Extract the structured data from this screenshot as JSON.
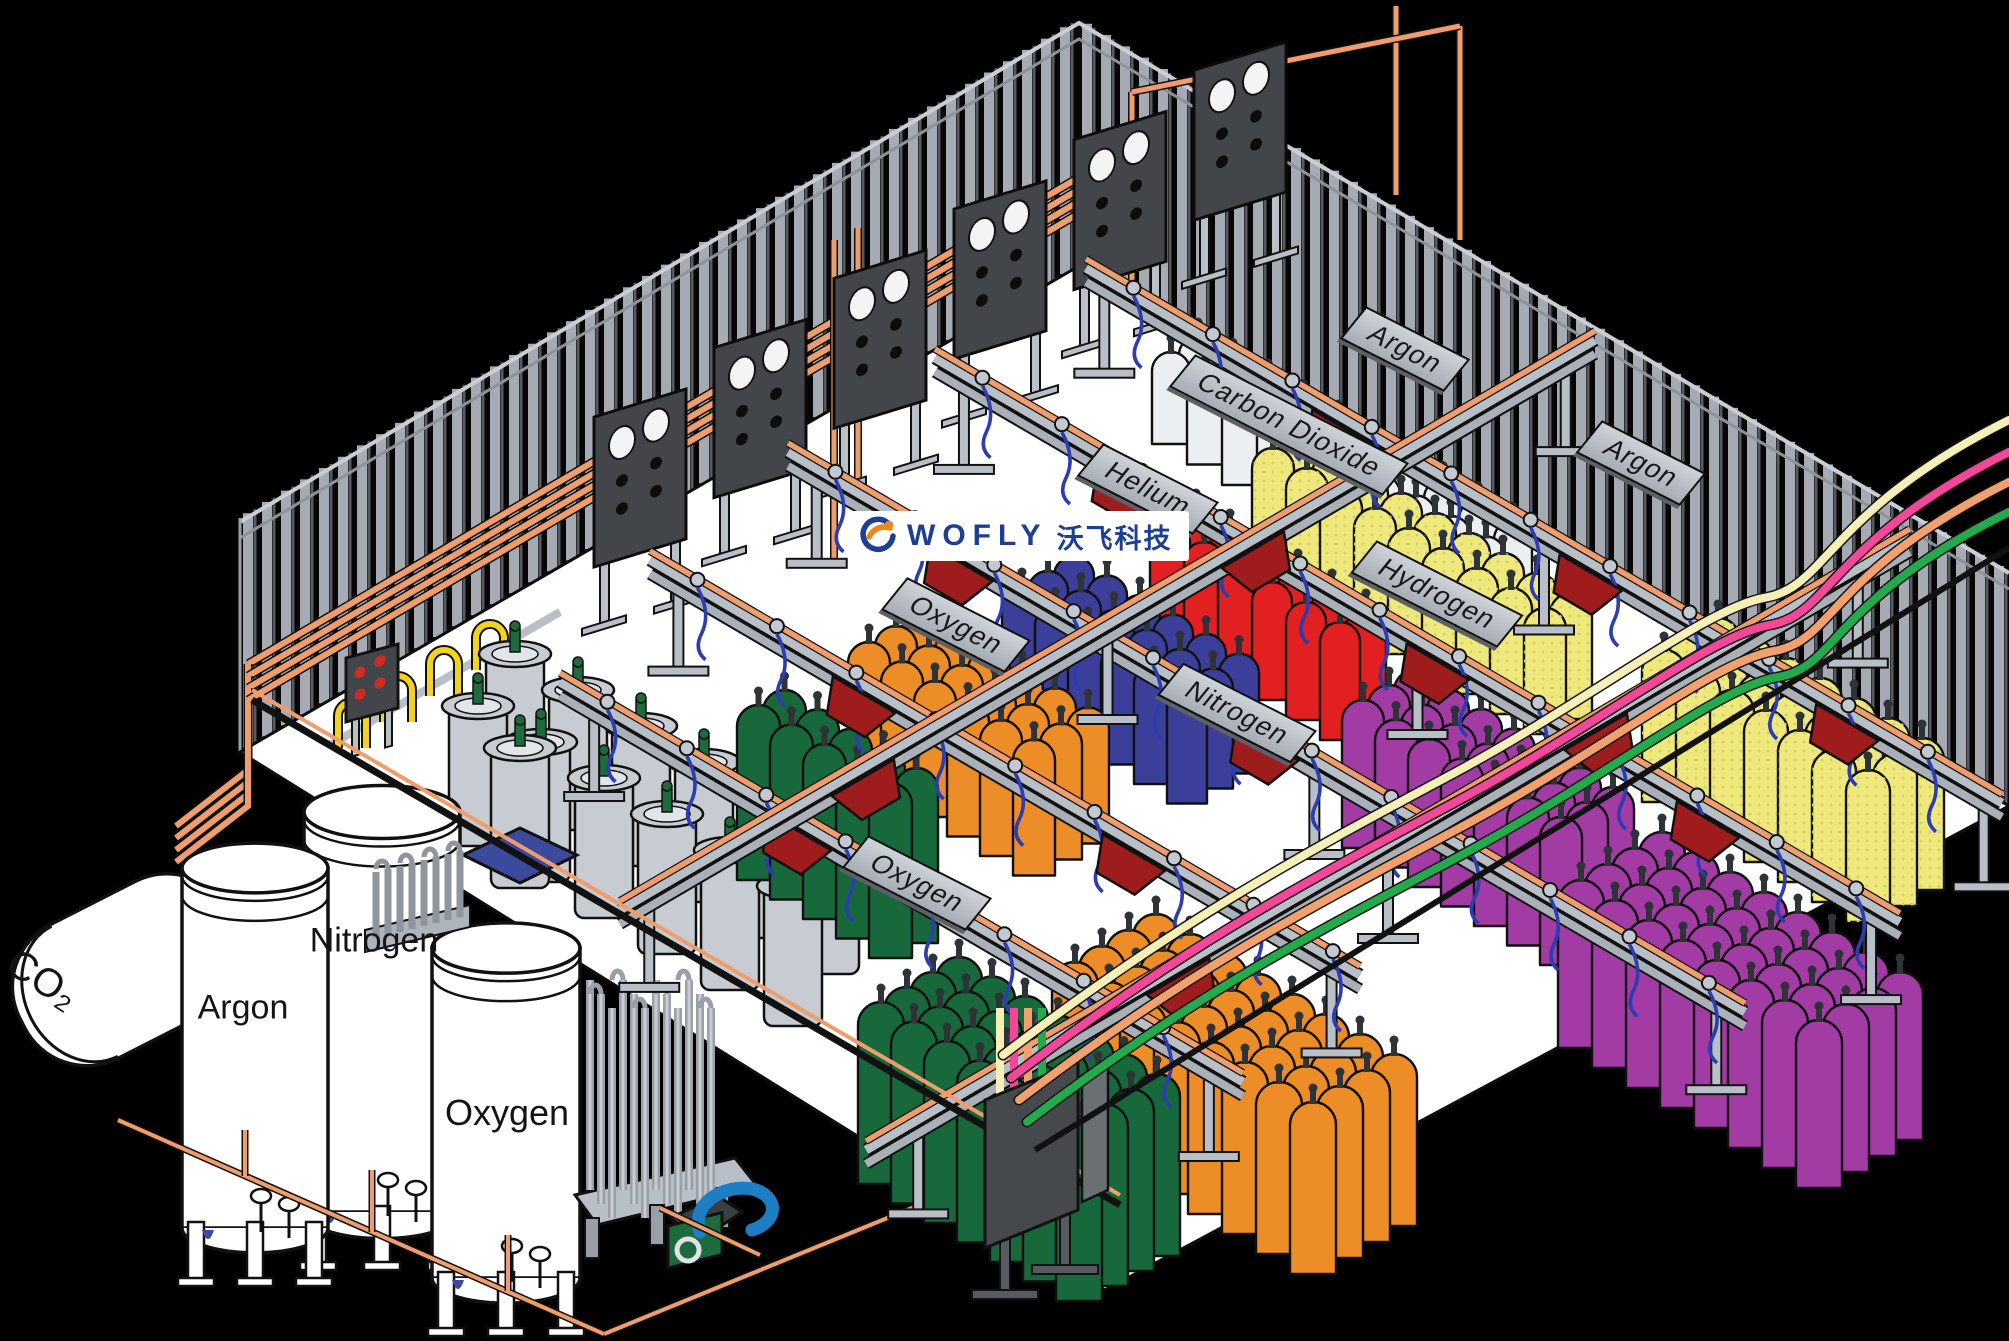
{
  "title": "Gas cylinder filling plant - isometric illustration",
  "logo": {
    "brand_en": "WOFLY",
    "brand_cn": "沃飞科技",
    "blue": "#1c3e94",
    "orange": "#f08519"
  },
  "signs": [
    {
      "id": "argon-top",
      "label": "Argon"
    },
    {
      "id": "carbon-dioxide",
      "label": "Carbon Dioxide"
    },
    {
      "id": "helium",
      "label": "Helium"
    },
    {
      "id": "argon-right",
      "label": "Argon"
    },
    {
      "id": "hydrogen",
      "label": "Hydrogen"
    },
    {
      "id": "nitrogen",
      "label": "Nitrogen"
    },
    {
      "id": "oxygen-upper",
      "label": "Oxygen"
    },
    {
      "id": "oxygen-lower",
      "label": "Oxygen"
    }
  ],
  "tanks": [
    {
      "id": "co2-tank",
      "label": "CO₂"
    },
    {
      "id": "argon-tank",
      "label": "Argon"
    },
    {
      "id": "nitrogen-tank",
      "label": "Nitrogen"
    },
    {
      "id": "oxygen-tank",
      "label": "Oxygen"
    }
  ],
  "colors": {
    "background": "#000000",
    "floor": "#ffffff",
    "wall_fill": "#060606",
    "wall_stripe": "#a6abb3",
    "wall_groove": "#565b61",
    "copper": "#f09d6d",
    "rail": "#b9bfc7",
    "panel": "#42464a",
    "bracket_red": "#9e1c1c",
    "hose_cream": "#f6f0b8",
    "hose_pink": "#f4479a",
    "hose_salmon": "#f2a06e",
    "hose_green": "#23aa4c",
    "pigtail_blue": "#2b3db0",
    "pallet_blue": "#3c4a9e",
    "valve_green": "#1d6b3c"
  },
  "cylinder_colors": {
    "green": "#17693b",
    "orange": "#ec8d28",
    "blue": "#3c3f99",
    "red": "#e32021",
    "yellow": "#efe97d",
    "purple": "#a23ba3",
    "white": "#eceff2",
    "dewar_gray": "#c7ccd3"
  }
}
